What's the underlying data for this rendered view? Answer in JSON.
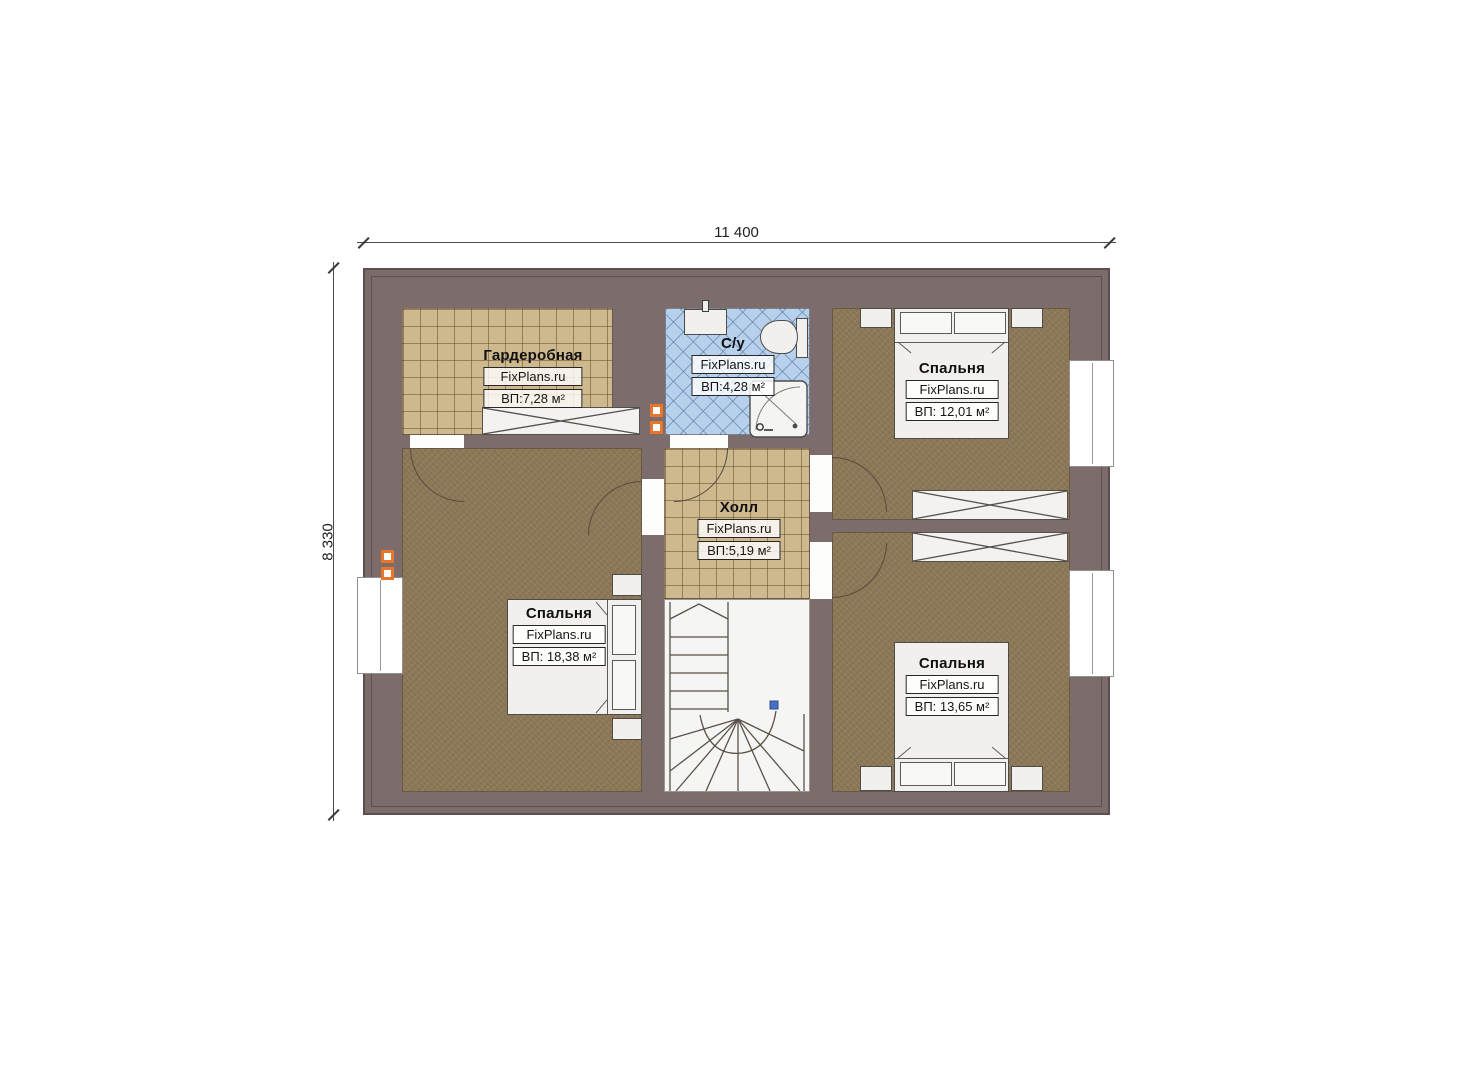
{
  "title": "Floor plan — attic level",
  "dimensions": {
    "width_label": "11 400",
    "height_label": "8 330"
  },
  "rooms": [
    {
      "name": "Гардеробная",
      "brand": "FixPlans.ru",
      "area": "ВП:7,28 м²"
    },
    {
      "name": "С/у",
      "brand": "FixPlans.ru",
      "area": "ВП:4,28 м²"
    },
    {
      "name": "Спальня",
      "brand": "FixPlans.ru",
      "area": "ВП: 12,01 м²"
    },
    {
      "name": "Холл",
      "brand": "FixPlans.ru",
      "area": "ВП:5,19 м²"
    },
    {
      "name": "Спальня",
      "brand": "FixPlans.ru",
      "area": "ВП: 18,38 м²"
    },
    {
      "name": "Спальня",
      "brand": "FixPlans.ru",
      "area": "ВП: 13,65 м²"
    }
  ],
  "colors": {
    "wall": "#7d6c6c",
    "tile_beige": "#cdb98d",
    "tile_blue": "#b7d1ec",
    "carpet_brown": "#8d7857",
    "furniture_fill": "#f1f0ed",
    "vent_orange": "#e8762a",
    "stair_marker_blue": "#4a6fc4"
  }
}
